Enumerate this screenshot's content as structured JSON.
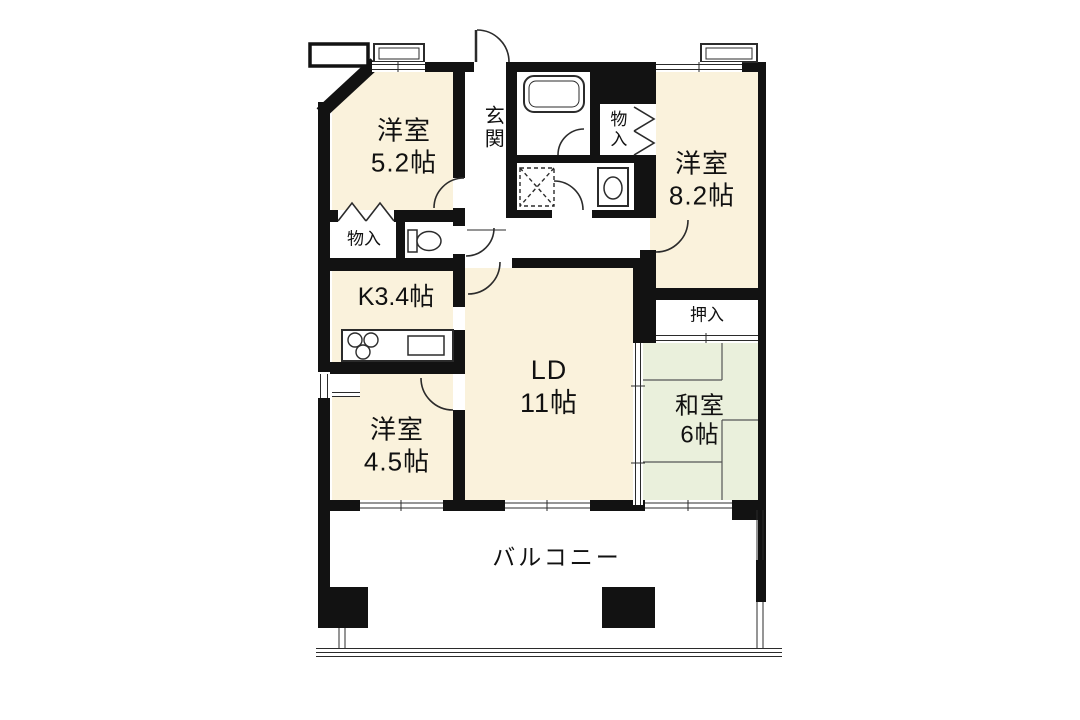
{
  "plan_type": "apartment-floor-plan",
  "rooms": {
    "bedroom_5_2": {
      "name": "洋室",
      "size": "5.2帖"
    },
    "bedroom_8_2": {
      "name": "洋室",
      "size": "8.2帖"
    },
    "bedroom_4_5": {
      "name": "洋室",
      "size": "4.5帖"
    },
    "living_dining": {
      "name": "LD",
      "size": "11帖"
    },
    "kitchen": {
      "label": "K3.4帖"
    },
    "japanese_room": {
      "name": "和室",
      "size": "6帖"
    },
    "balcony": {
      "label": "バルコニー"
    },
    "entrance": {
      "label": "玄関"
    },
    "storage_top_right": {
      "label": "物入"
    },
    "storage_left": {
      "label": "物入"
    },
    "closet_oshiire": {
      "label": "押入"
    }
  },
  "fixtures": [
    "bathtub",
    "washing-machine-pan",
    "washbasin",
    "toilet",
    "stove-burners",
    "kitchen-sink",
    "tatami-mats",
    "balcony-pillars"
  ],
  "colors": {
    "background": "#ffffff",
    "wall": "#121212",
    "western_room_fill": "#faf2dc",
    "tatami_room_fill": "#eaf0dc",
    "line": "#2b2b2b"
  }
}
